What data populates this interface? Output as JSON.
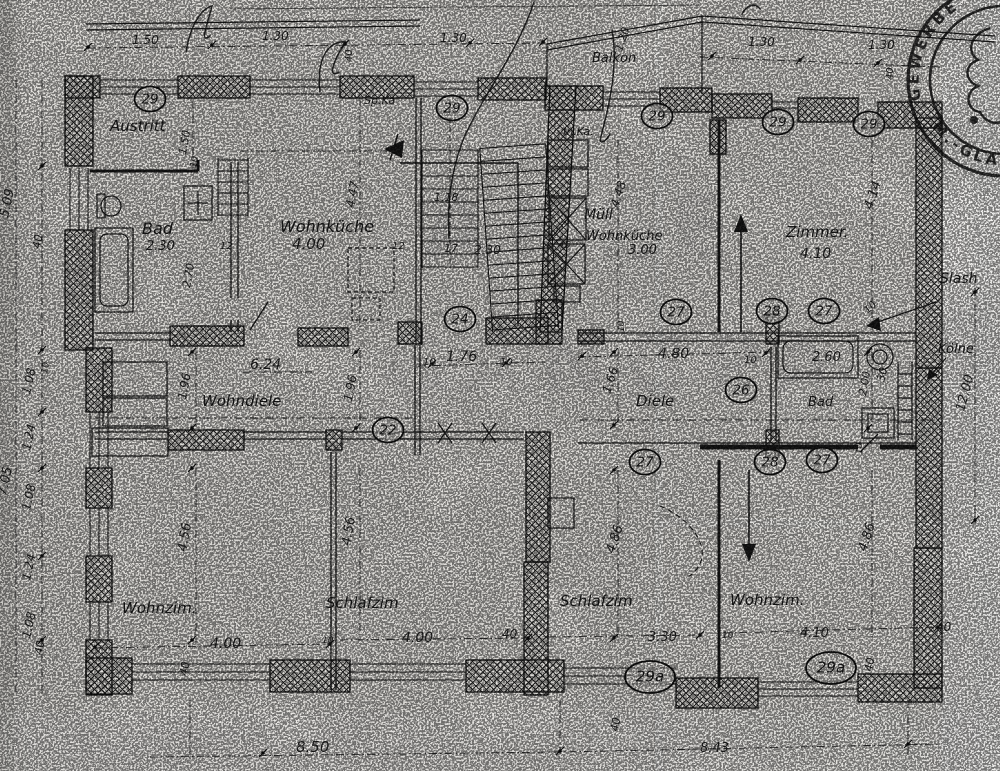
{
  "page": {
    "paper_color": "#e9e7e3",
    "ink_color": "#1c1c1c"
  },
  "plan": {
    "rooms": [
      {
        "t": "Austritt",
        "x": 110,
        "y": 131,
        "s": 15
      },
      {
        "t": "Bad",
        "x": 142,
        "y": 234,
        "s": 16
      },
      {
        "t": "Wohnküche",
        "x": 280,
        "y": 232,
        "s": 16
      },
      {
        "t": "Müll",
        "x": 584,
        "y": 219,
        "s": 14
      },
      {
        "t": "Wohnküche",
        "x": 586,
        "y": 240,
        "s": 13
      },
      {
        "t": "Zimmer.",
        "x": 786,
        "y": 237,
        "s": 15
      },
      {
        "t": "Balkon",
        "x": 592,
        "y": 62,
        "s": 13
      },
      {
        "t": "Sp.Ka",
        "x": 364,
        "y": 104,
        "s": 11
      },
      {
        "t": "In.Ka.",
        "x": 563,
        "y": 135,
        "s": 11
      },
      {
        "t": "Wohndiele",
        "x": 202,
        "y": 406,
        "s": 15
      },
      {
        "t": "Diele",
        "x": 636,
        "y": 406,
        "s": 15
      },
      {
        "t": "Bad",
        "x": 808,
        "y": 406,
        "s": 13
      },
      {
        "t": "Wohnzim.",
        "x": 122,
        "y": 613,
        "s": 15
      },
      {
        "t": "Schlafzim",
        "x": 326,
        "y": 608,
        "s": 15
      },
      {
        "t": "Schlafzim",
        "x": 560,
        "y": 606,
        "s": 15
      },
      {
        "t": "Wohnzim.",
        "x": 730,
        "y": 605,
        "s": 15
      },
      {
        "t": "Slash",
        "x": 940,
        "y": 283,
        "s": 14
      },
      {
        "t": "Kölne",
        "x": 938,
        "y": 353,
        "s": 13
      }
    ],
    "dimensions": [
      {
        "t": "1.50",
        "x": 132,
        "y": 44
      },
      {
        "t": "1.30",
        "x": 262,
        "y": 40
      },
      {
        "t": "1.30",
        "x": 440,
        "y": 42
      },
      {
        "t": "1.30",
        "x": 748,
        "y": 46
      },
      {
        "t": "1.30",
        "x": 868,
        "y": 49
      },
      {
        "t": "40",
        "x": 352,
        "y": 62,
        "r": -90,
        "s": 10
      },
      {
        "t": "40",
        "x": 893,
        "y": 80,
        "r": -90,
        "s": 10
      },
      {
        "t": "1.20",
        "x": 622,
        "y": 52,
        "r": -72,
        "s": 11
      },
      {
        "t": "2.30",
        "x": 146,
        "y": 250,
        "s": 13
      },
      {
        "t": "4.00",
        "x": 292,
        "y": 249,
        "s": 15
      },
      {
        "t": "3.00",
        "x": 628,
        "y": 254,
        "s": 13
      },
      {
        "t": "4.10",
        "x": 800,
        "y": 258,
        "s": 14
      },
      {
        "t": "12",
        "x": 220,
        "y": 249,
        "s": 10
      },
      {
        "t": "12",
        "x": 392,
        "y": 249,
        "s": 10
      },
      {
        "t": "17",
        "x": 444,
        "y": 252,
        "s": 11
      },
      {
        "t": "2.30",
        "x": 474,
        "y": 254,
        "s": 12
      },
      {
        "t": "45",
        "x": 558,
        "y": 248,
        "s": 10
      },
      {
        "t": "1.18",
        "x": 434,
        "y": 201,
        "s": 11
      },
      {
        "t": "4.47",
        "x": 354,
        "y": 208,
        "r": -80,
        "s": 12
      },
      {
        "t": "1.50",
        "x": 186,
        "y": 155,
        "r": -80,
        "s": 11
      },
      {
        "t": "10",
        "x": 196,
        "y": 168,
        "r": -80,
        "s": 9
      },
      {
        "t": "2.70",
        "x": 190,
        "y": 288,
        "r": -80,
        "s": 11
      },
      {
        "t": "4.14",
        "x": 872,
        "y": 210,
        "r": -72,
        "s": 13
      },
      {
        "t": "4.48",
        "x": 618,
        "y": 208,
        "r": -72,
        "s": 12
      },
      {
        "t": "6.24",
        "x": 250,
        "y": 369,
        "s": 14
      },
      {
        "t": "10",
        "x": 423,
        "y": 365,
        "s": 10
      },
      {
        "t": "1.76",
        "x": 446,
        "y": 361,
        "s": 14
      },
      {
        "t": "10",
        "x": 500,
        "y": 365,
        "s": 10
      },
      {
        "t": "4.80",
        "x": 658,
        "y": 358,
        "s": 14
      },
      {
        "t": "10",
        "x": 744,
        "y": 363,
        "s": 10
      },
      {
        "t": "2.60",
        "x": 812,
        "y": 361,
        "s": 13
      },
      {
        "t": "30",
        "x": 884,
        "y": 382,
        "r": -75,
        "s": 11
      },
      {
        "t": "2.00",
        "x": 866,
        "y": 396,
        "r": -80,
        "s": 11
      },
      {
        "t": "10",
        "x": 868,
        "y": 314,
        "r": -45,
        "s": 10
      },
      {
        "t": "1.96",
        "x": 186,
        "y": 400,
        "r": -80,
        "s": 12
      },
      {
        "t": "1.96",
        "x": 352,
        "y": 402,
        "r": -80,
        "s": 12
      },
      {
        "t": "1.66",
        "x": 610,
        "y": 394,
        "r": -72,
        "s": 12
      },
      {
        "t": "10",
        "x": 624,
        "y": 332,
        "r": -90,
        "s": 9
      },
      {
        "t": "10",
        "x": 862,
        "y": 454,
        "r": -90,
        "s": 9
      },
      {
        "t": "12.00",
        "x": 964,
        "y": 412,
        "r": -75,
        "s": 13
      },
      {
        "t": "4.56",
        "x": 186,
        "y": 552,
        "r": -80,
        "s": 13
      },
      {
        "t": "4.56",
        "x": 350,
        "y": 546,
        "r": -80,
        "s": 13
      },
      {
        "t": "4.86",
        "x": 614,
        "y": 554,
        "r": -72,
        "s": 13
      },
      {
        "t": "4.86",
        "x": 866,
        "y": 552,
        "r": -72,
        "s": 13
      },
      {
        "t": "4.00",
        "x": 210,
        "y": 648,
        "s": 14
      },
      {
        "t": "10",
        "x": 322,
        "y": 643,
        "s": 9
      },
      {
        "t": "4.00",
        "x": 402,
        "y": 642,
        "s": 14
      },
      {
        "t": "40",
        "x": 502,
        "y": 638,
        "s": 12
      },
      {
        "t": "3.30",
        "x": 648,
        "y": 641,
        "s": 13
      },
      {
        "t": "10",
        "x": 722,
        "y": 638,
        "s": 9
      },
      {
        "t": "4.10",
        "x": 800,
        "y": 637,
        "s": 13
      },
      {
        "t": "40",
        "x": 936,
        "y": 631,
        "s": 12
      },
      {
        "t": "40",
        "x": 872,
        "y": 672,
        "r": -80,
        "s": 11
      },
      {
        "t": "40",
        "x": 187,
        "y": 676,
        "r": -80,
        "s": 11
      },
      {
        "t": "5.09",
        "x": 8,
        "y": 218,
        "r": -78,
        "s": 13
      },
      {
        "t": "40",
        "x": 40,
        "y": 249,
        "r": -80,
        "s": 11
      },
      {
        "t": "10",
        "x": 47,
        "y": 374,
        "r": -80,
        "s": 9
      },
      {
        "t": "1.08",
        "x": 30,
        "y": 395,
        "r": -78,
        "s": 12
      },
      {
        "t": "1.24",
        "x": 30,
        "y": 451,
        "r": -78,
        "s": 12
      },
      {
        "t": "1.08",
        "x": 30,
        "y": 511,
        "r": -78,
        "s": 12
      },
      {
        "t": "7.05",
        "x": 6,
        "y": 496,
        "r": -78,
        "s": 13
      },
      {
        "t": "1.24",
        "x": 30,
        "y": 581,
        "r": -78,
        "s": 12
      },
      {
        "t": "1.08",
        "x": 30,
        "y": 639,
        "r": -78,
        "s": 12
      },
      {
        "t": "40",
        "x": 42,
        "y": 655,
        "r": -80,
        "s": 11
      },
      {
        "t": "8.50",
        "x": 296,
        "y": 752,
        "s": 15
      },
      {
        "t": "8.43",
        "x": 700,
        "y": 752,
        "s": 13
      },
      {
        "t": "40",
        "x": 618,
        "y": 732,
        "r": -80,
        "s": 11
      }
    ],
    "badges": [
      {
        "t": "29",
        "x": 150,
        "y": 99
      },
      {
        "t": "29",
        "x": 452,
        "y": 108
      },
      {
        "t": "29",
        "x": 657,
        "y": 116
      },
      {
        "t": "29",
        "x": 778,
        "y": 122
      },
      {
        "t": "29",
        "x": 869,
        "y": 124
      },
      {
        "t": "24",
        "x": 460,
        "y": 319
      },
      {
        "t": "27",
        "x": 676,
        "y": 312
      },
      {
        "t": "28",
        "x": 772,
        "y": 311
      },
      {
        "t": "27",
        "x": 824,
        "y": 311
      },
      {
        "t": "26",
        "x": 741,
        "y": 390
      },
      {
        "t": "22",
        "x": 388,
        "y": 430
      },
      {
        "t": "27",
        "x": 645,
        "y": 462
      },
      {
        "t": "28",
        "x": 770,
        "y": 462
      },
      {
        "t": "27",
        "x": 822,
        "y": 460
      },
      {
        "t": "29a",
        "x": 650,
        "y": 677
      },
      {
        "t": "29a",
        "x": 831,
        "y": 668
      }
    ]
  },
  "stamp": {
    "top": "GEWERBE",
    "bottom": "M.-GLA"
  },
  "watermark": {
    "l1": "AKLE",
    "l2": "GANGPA"
  }
}
